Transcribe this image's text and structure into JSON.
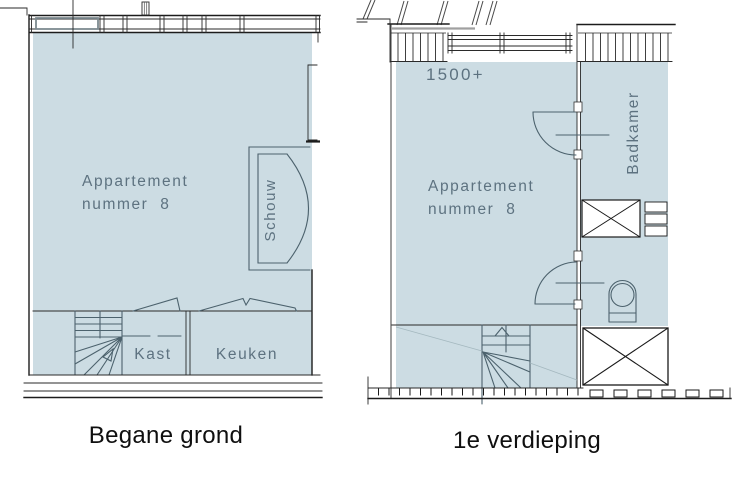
{
  "page": {
    "background": "#ffffff",
    "width": 732,
    "height": 484
  },
  "colors": {
    "room_fill": "#ccdce3",
    "interior_line": "#4c626d",
    "wall_line": "#1c1c1c",
    "label_text": "#5d7280",
    "caption_text": "#0f0f0f"
  },
  "plans": [
    {
      "id": "begane-grond",
      "caption": "Begane grond",
      "labels": {
        "apartment_line1": "Appartement",
        "apartment_line2": "nummer  8",
        "schouw": "Schouw",
        "kast": "Kast",
        "keuken": "Keuken"
      }
    },
    {
      "id": "eerste-verdieping",
      "caption": "1e verdieping",
      "labels": {
        "height_marker": "1500+",
        "apartment_line1": "Appartement",
        "apartment_line2": "nummer  8",
        "badkamer": "Badkamer"
      }
    }
  ]
}
